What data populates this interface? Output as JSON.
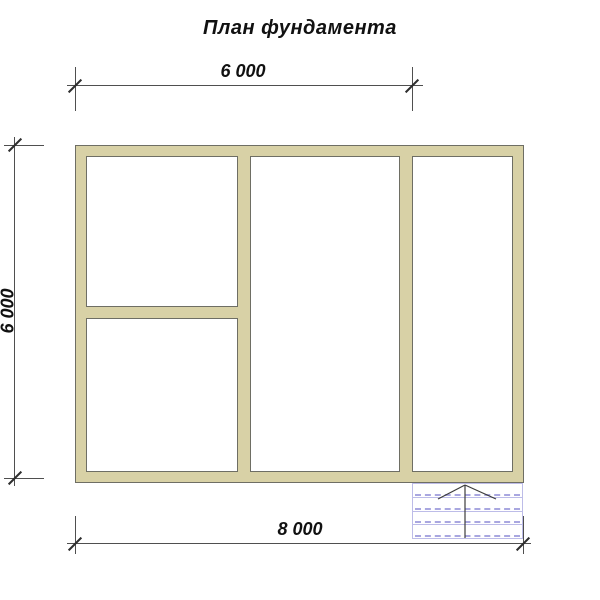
{
  "title": "План фундамента",
  "dimensions": {
    "top": {
      "label": "6 000"
    },
    "left": {
      "label": "6 000"
    },
    "bottom": {
      "label": "8 000"
    }
  },
  "plan": {
    "rooms": 4,
    "porch_steps": 4
  },
  "colors": {
    "background": "#ffffff",
    "wallFill": "#d8d1a6",
    "wallStroke": "#6e6e64",
    "roomFill": "#ffffff",
    "dimLine": "#4f4f4f",
    "tick": "#2e2e2e",
    "textColor": "#111111",
    "porchSolid": "#bdbce8",
    "porchDash": "#a9a7e0",
    "arrow": "#3c3c3c"
  }
}
